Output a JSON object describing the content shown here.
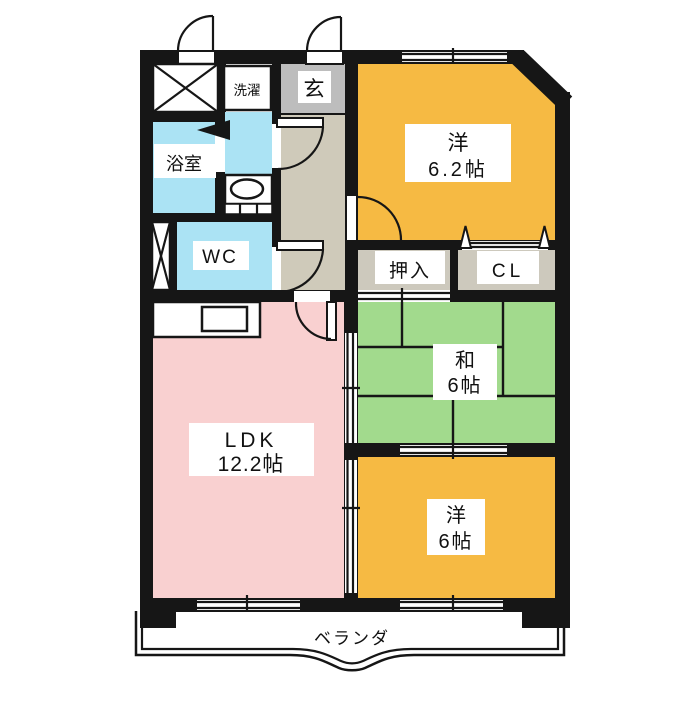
{
  "floorplan": {
    "rooms": {
      "western_6_2": {
        "name": "洋",
        "area": "6.2帖"
      },
      "japanese_6": {
        "name": "和",
        "area": "6帖"
      },
      "western_6": {
        "name": "洋",
        "area": "6帖"
      },
      "ldk": {
        "name": "LDK",
        "area": "12.2帖"
      },
      "bath": {
        "name": "浴室"
      },
      "toilet": {
        "name": "WC"
      },
      "laundry": {
        "name": "洗濯"
      },
      "entrance": {
        "name": "玄"
      },
      "futon_closet": {
        "name": "押入"
      },
      "closet": {
        "name": "CL"
      },
      "balcony": {
        "name": "ベランダ"
      }
    },
    "colors": {
      "wall": "#161616",
      "western_room": "#F6BA43",
      "japanese_room": "#A2DA8D",
      "ldk": "#F9D0D0",
      "wet_area": "#ABE3F4",
      "entrance": "#BDBDBD",
      "hallway": "#CFCABA",
      "closet": "#CDC9BD",
      "label_bg": "#FFFFFF"
    }
  }
}
